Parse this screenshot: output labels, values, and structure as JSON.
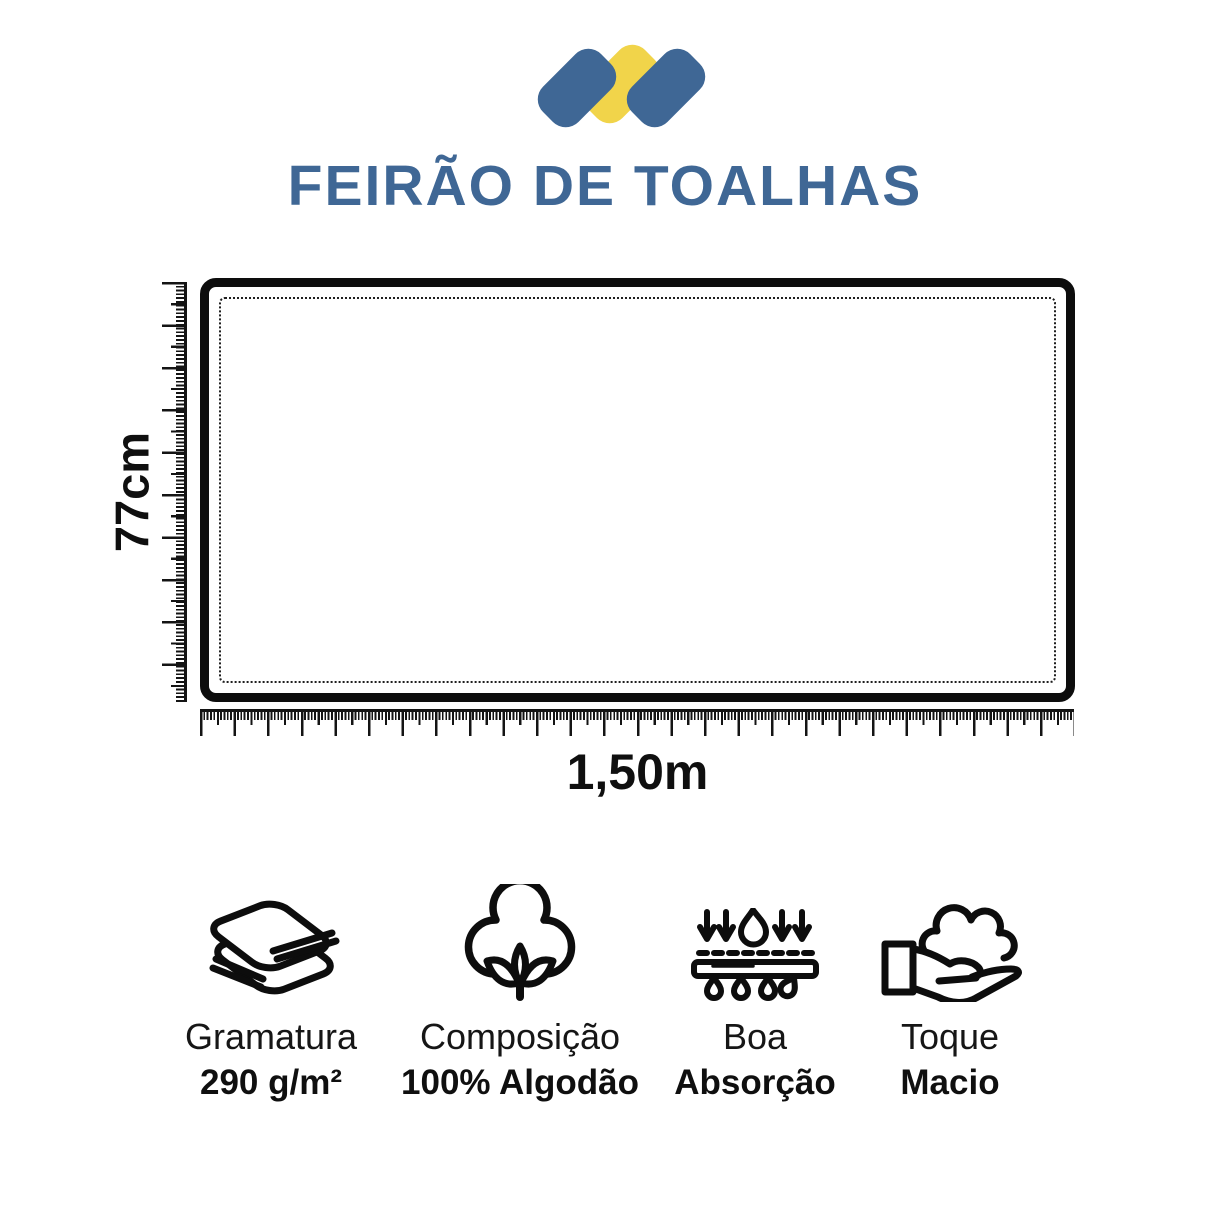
{
  "brand": {
    "title": "FEIRÃO DE TOALHAS",
    "logo_colors": {
      "blue": "#3F6795",
      "yellow": "#F1D44A"
    }
  },
  "diagram": {
    "height_label": "77cm",
    "width_label": "1,50m"
  },
  "features": [
    {
      "icon": "folded-towels-icon",
      "label": "Gramatura",
      "value": "290 g/m²"
    },
    {
      "icon": "cotton-flower-icon",
      "label": "Composição",
      "value": "100% Algodão"
    },
    {
      "icon": "water-absorption-icon",
      "label": "Boa",
      "value": "Absorção"
    },
    {
      "icon": "soft-touch-hand-icon",
      "label": "Toque",
      "value": "Macio"
    }
  ]
}
